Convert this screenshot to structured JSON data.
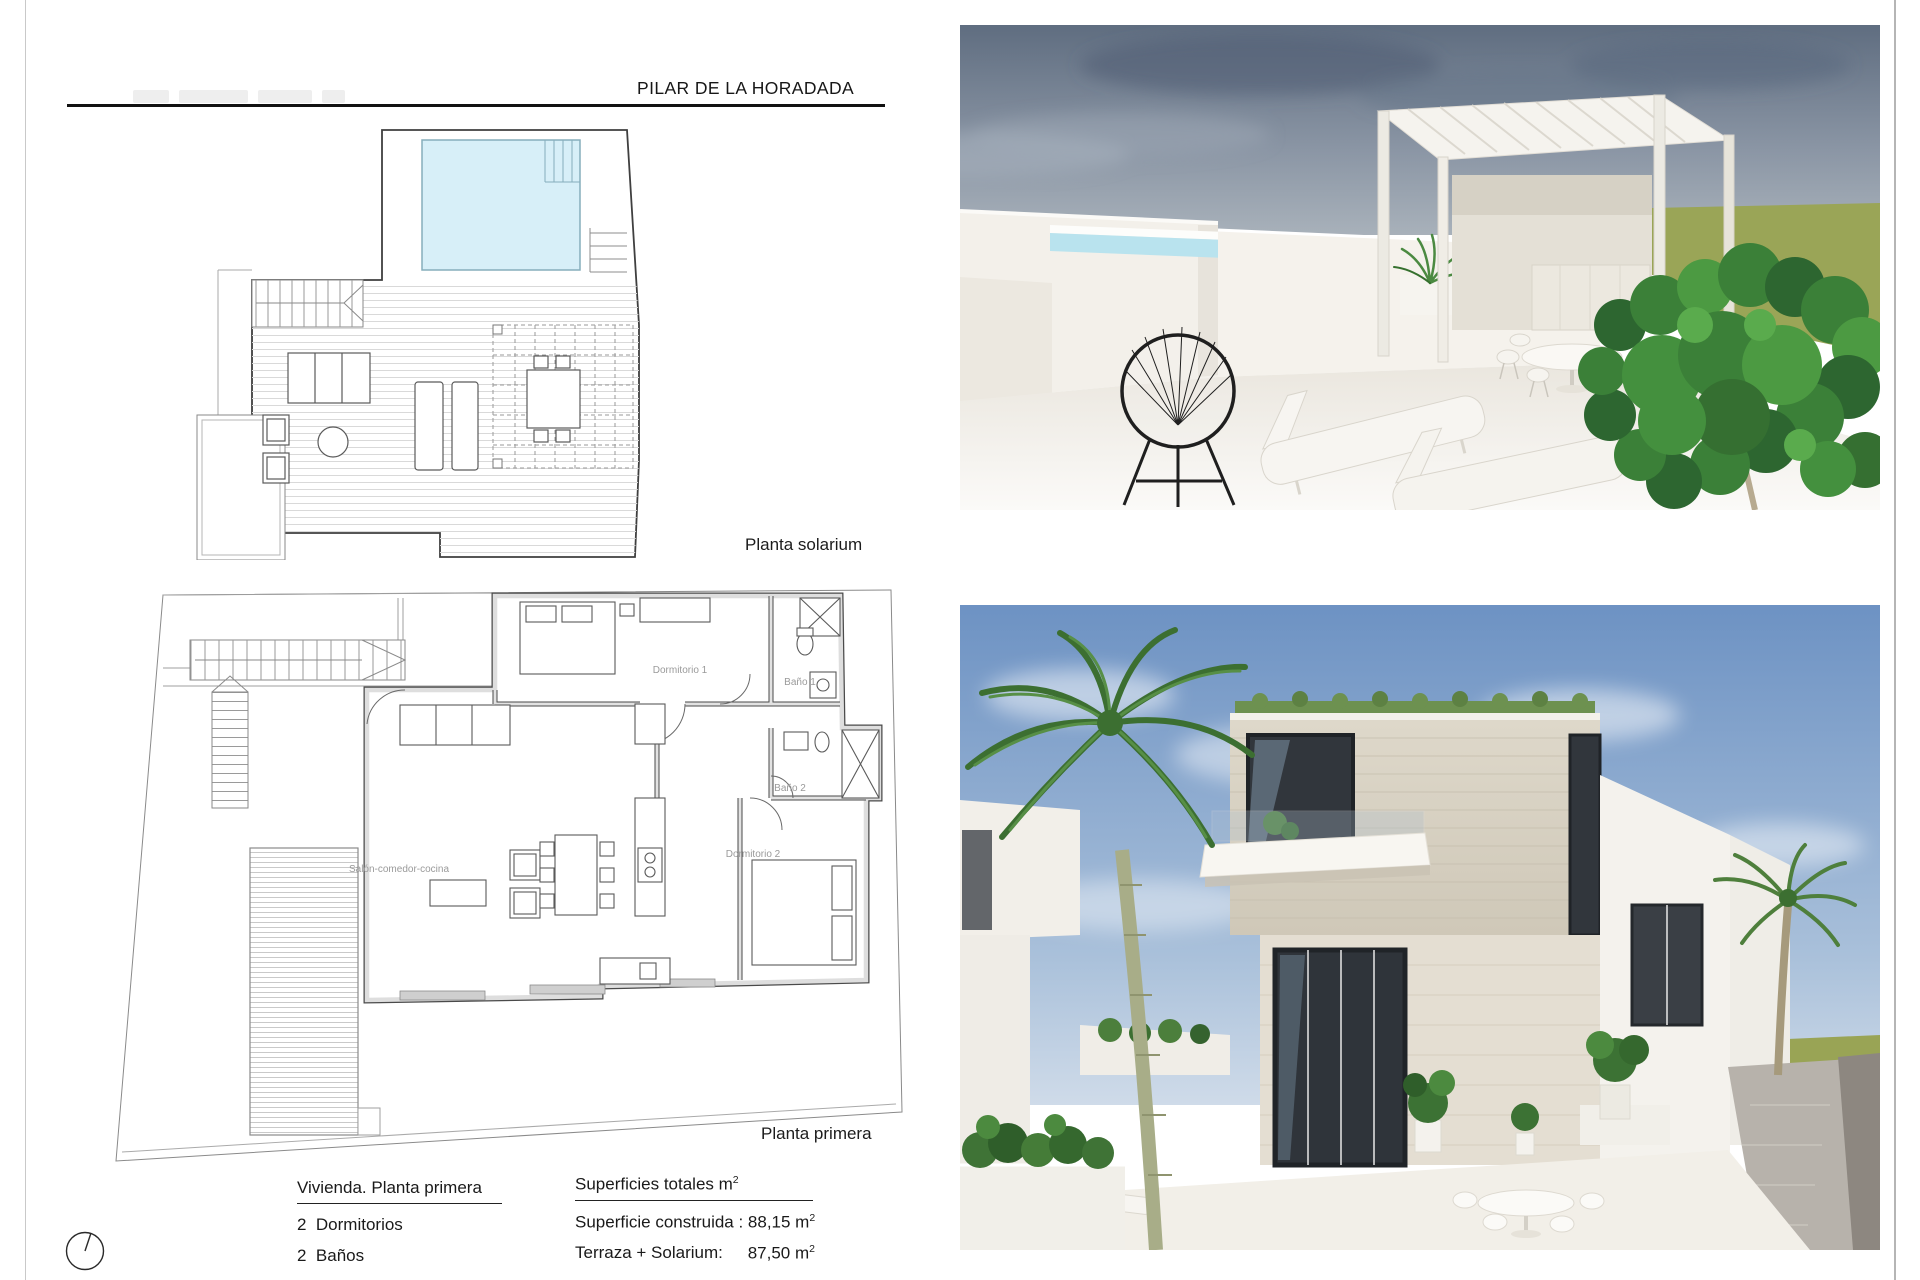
{
  "header": {
    "title": "PILAR DE LA HORADADA"
  },
  "plans": {
    "solarium": {
      "caption": "Planta solarium"
    },
    "primera": {
      "caption": "Planta primera",
      "rooms": {
        "dormitorio1": "Dormitorio 1",
        "bano1": "Baño 1",
        "bano2": "Baño 2",
        "dormitorio2": "Dormitorio 2",
        "salon": "Salón-comedor-cocina"
      }
    }
  },
  "summary": {
    "dwelling": {
      "heading": "Vivienda. Planta primera",
      "bedrooms": "2  Dormitorios",
      "bathrooms": "2  Baños"
    },
    "areas": {
      "heading_text": "Superficies totales m",
      "heading_sup": "2",
      "built_label": "Superficie construida : 88,15 m",
      "built_sup": "2",
      "terrace_label": "Terraza + Solarium:",
      "terrace_value": "87,50 m",
      "terrace_sup": "2"
    }
  },
  "palette": {
    "line_dark": "#3f3f3f",
    "wall_gray": "#dedede",
    "pool_plan": "#d7eff8",
    "deck_hatch": "#d6d6d6",
    "label_gray": "#9a9a9a",
    "sky_terrace_top": "#5f6d80",
    "sky_terrace_low": "#a8b1ba",
    "grass_olive": "#99a455",
    "sky_villa": "#6d92c3",
    "water_cyan": "#52c2d8",
    "stone_beige": "#d9d3c5",
    "window_dark": "#31363c",
    "foliage_green": "#3c7234",
    "white_wall": "#f3f0ea"
  }
}
